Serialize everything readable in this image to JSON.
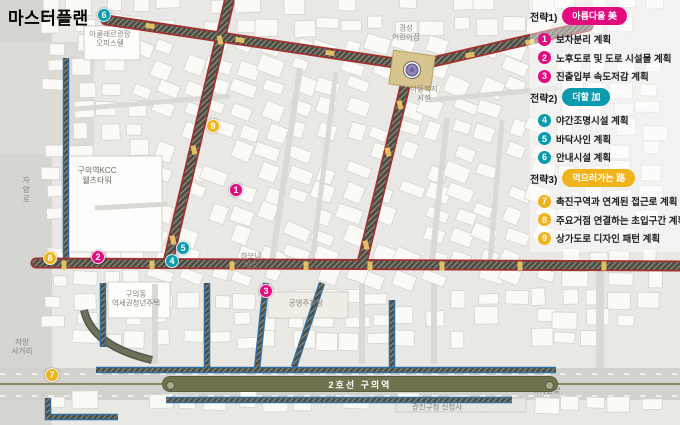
{
  "title": "마스터플랜",
  "colors": {
    "pink": "#e5097f",
    "teal": "#0a9bae",
    "yellow": "#f0b31c",
    "road_red": "#a03030",
    "road_blue": "#2f6fa8",
    "olive": "#72724f"
  },
  "legend": {
    "groups": [
      {
        "label": "전략1)",
        "pill": "아름다울 美",
        "color": "#e5097f",
        "items": [
          {
            "num": "1",
            "text": "보차분리 계획"
          },
          {
            "num": "2",
            "text": "노후도로 및 도로 시설물 계획"
          },
          {
            "num": "3",
            "text": "진출입부 속도저감 계획"
          }
        ]
      },
      {
        "label": "전략2)",
        "pill": "더할 加",
        "color": "#0a9bae",
        "items": [
          {
            "num": "4",
            "text": "야간조명시설 계획"
          },
          {
            "num": "5",
            "text": "바닥사인 계획"
          },
          {
            "num": "6",
            "text": "안내시설 계획"
          }
        ]
      },
      {
        "label": "전략3)",
        "pill": "먹으러가는 路",
        "color": "#f0b31c",
        "items": [
          {
            "num": "7",
            "text": "촉진구역과 연계된 접근로 계획"
          },
          {
            "num": "8",
            "text": "주요거점 연결하는 초입구간 계획"
          },
          {
            "num": "9",
            "text": "상가도로 디자인 패턴 계획"
          }
        ]
      }
    ]
  },
  "map": {
    "rail_label": "2호선 구의역",
    "labels": [
      {
        "name": "label-officetel",
        "text": "아클레르광장\n오피스텔",
        "x": 110,
        "y": 39,
        "style": ""
      },
      {
        "name": "label-daycare",
        "text": "경성\n어린이집",
        "x": 406,
        "y": 33,
        "style": ""
      },
      {
        "name": "label-child-welfare",
        "text": "아동복지\n시설",
        "x": 424,
        "y": 94,
        "style": ""
      },
      {
        "name": "label-kcc-tower",
        "text": "구의역KCC\n웰츠타워",
        "x": 97,
        "y": 176,
        "style": "dark"
      },
      {
        "name": "label-jayang-ro",
        "text": "자양로",
        "x": 26,
        "y": 190,
        "style": "vertical"
      },
      {
        "name": "label-harmony-mart",
        "text": "하모니\n마트",
        "x": 251,
        "y": 261,
        "style": ""
      },
      {
        "name": "label-guui-housing",
        "text": "구의동\n역세권청년주택",
        "x": 136,
        "y": 299,
        "style": ""
      },
      {
        "name": "label-public-parking",
        "text": "공영주차장",
        "x": 306,
        "y": 303,
        "style": ""
      },
      {
        "name": "label-jayang-crossing",
        "text": "자양\n사거리",
        "x": 22,
        "y": 347,
        "style": ""
      },
      {
        "name": "label-gwangjin-office",
        "text": "광진구청 신청사",
        "x": 437,
        "y": 407,
        "style": ""
      },
      {
        "name": "label-achasan-ro",
        "text": "아차산로",
        "x": 546,
        "y": 391,
        "style": "italic"
      }
    ],
    "markers": [
      {
        "num": "1",
        "group": "pink",
        "x": 236,
        "y": 190
      },
      {
        "num": "2",
        "group": "pink",
        "x": 98,
        "y": 257
      },
      {
        "num": "3",
        "group": "pink",
        "x": 266,
        "y": 291
      },
      {
        "num": "4",
        "group": "teal",
        "x": 172,
        "y": 261
      },
      {
        "num": "5",
        "group": "teal",
        "x": 183,
        "y": 248
      },
      {
        "num": "6",
        "group": "teal",
        "x": 104,
        "y": 15
      },
      {
        "num": "7",
        "group": "yellow",
        "x": 52,
        "y": 375
      },
      {
        "num": "8",
        "group": "yellow",
        "x": 50,
        "y": 258
      },
      {
        "num": "9",
        "group": "yellow",
        "x": 213,
        "y": 126
      }
    ]
  }
}
